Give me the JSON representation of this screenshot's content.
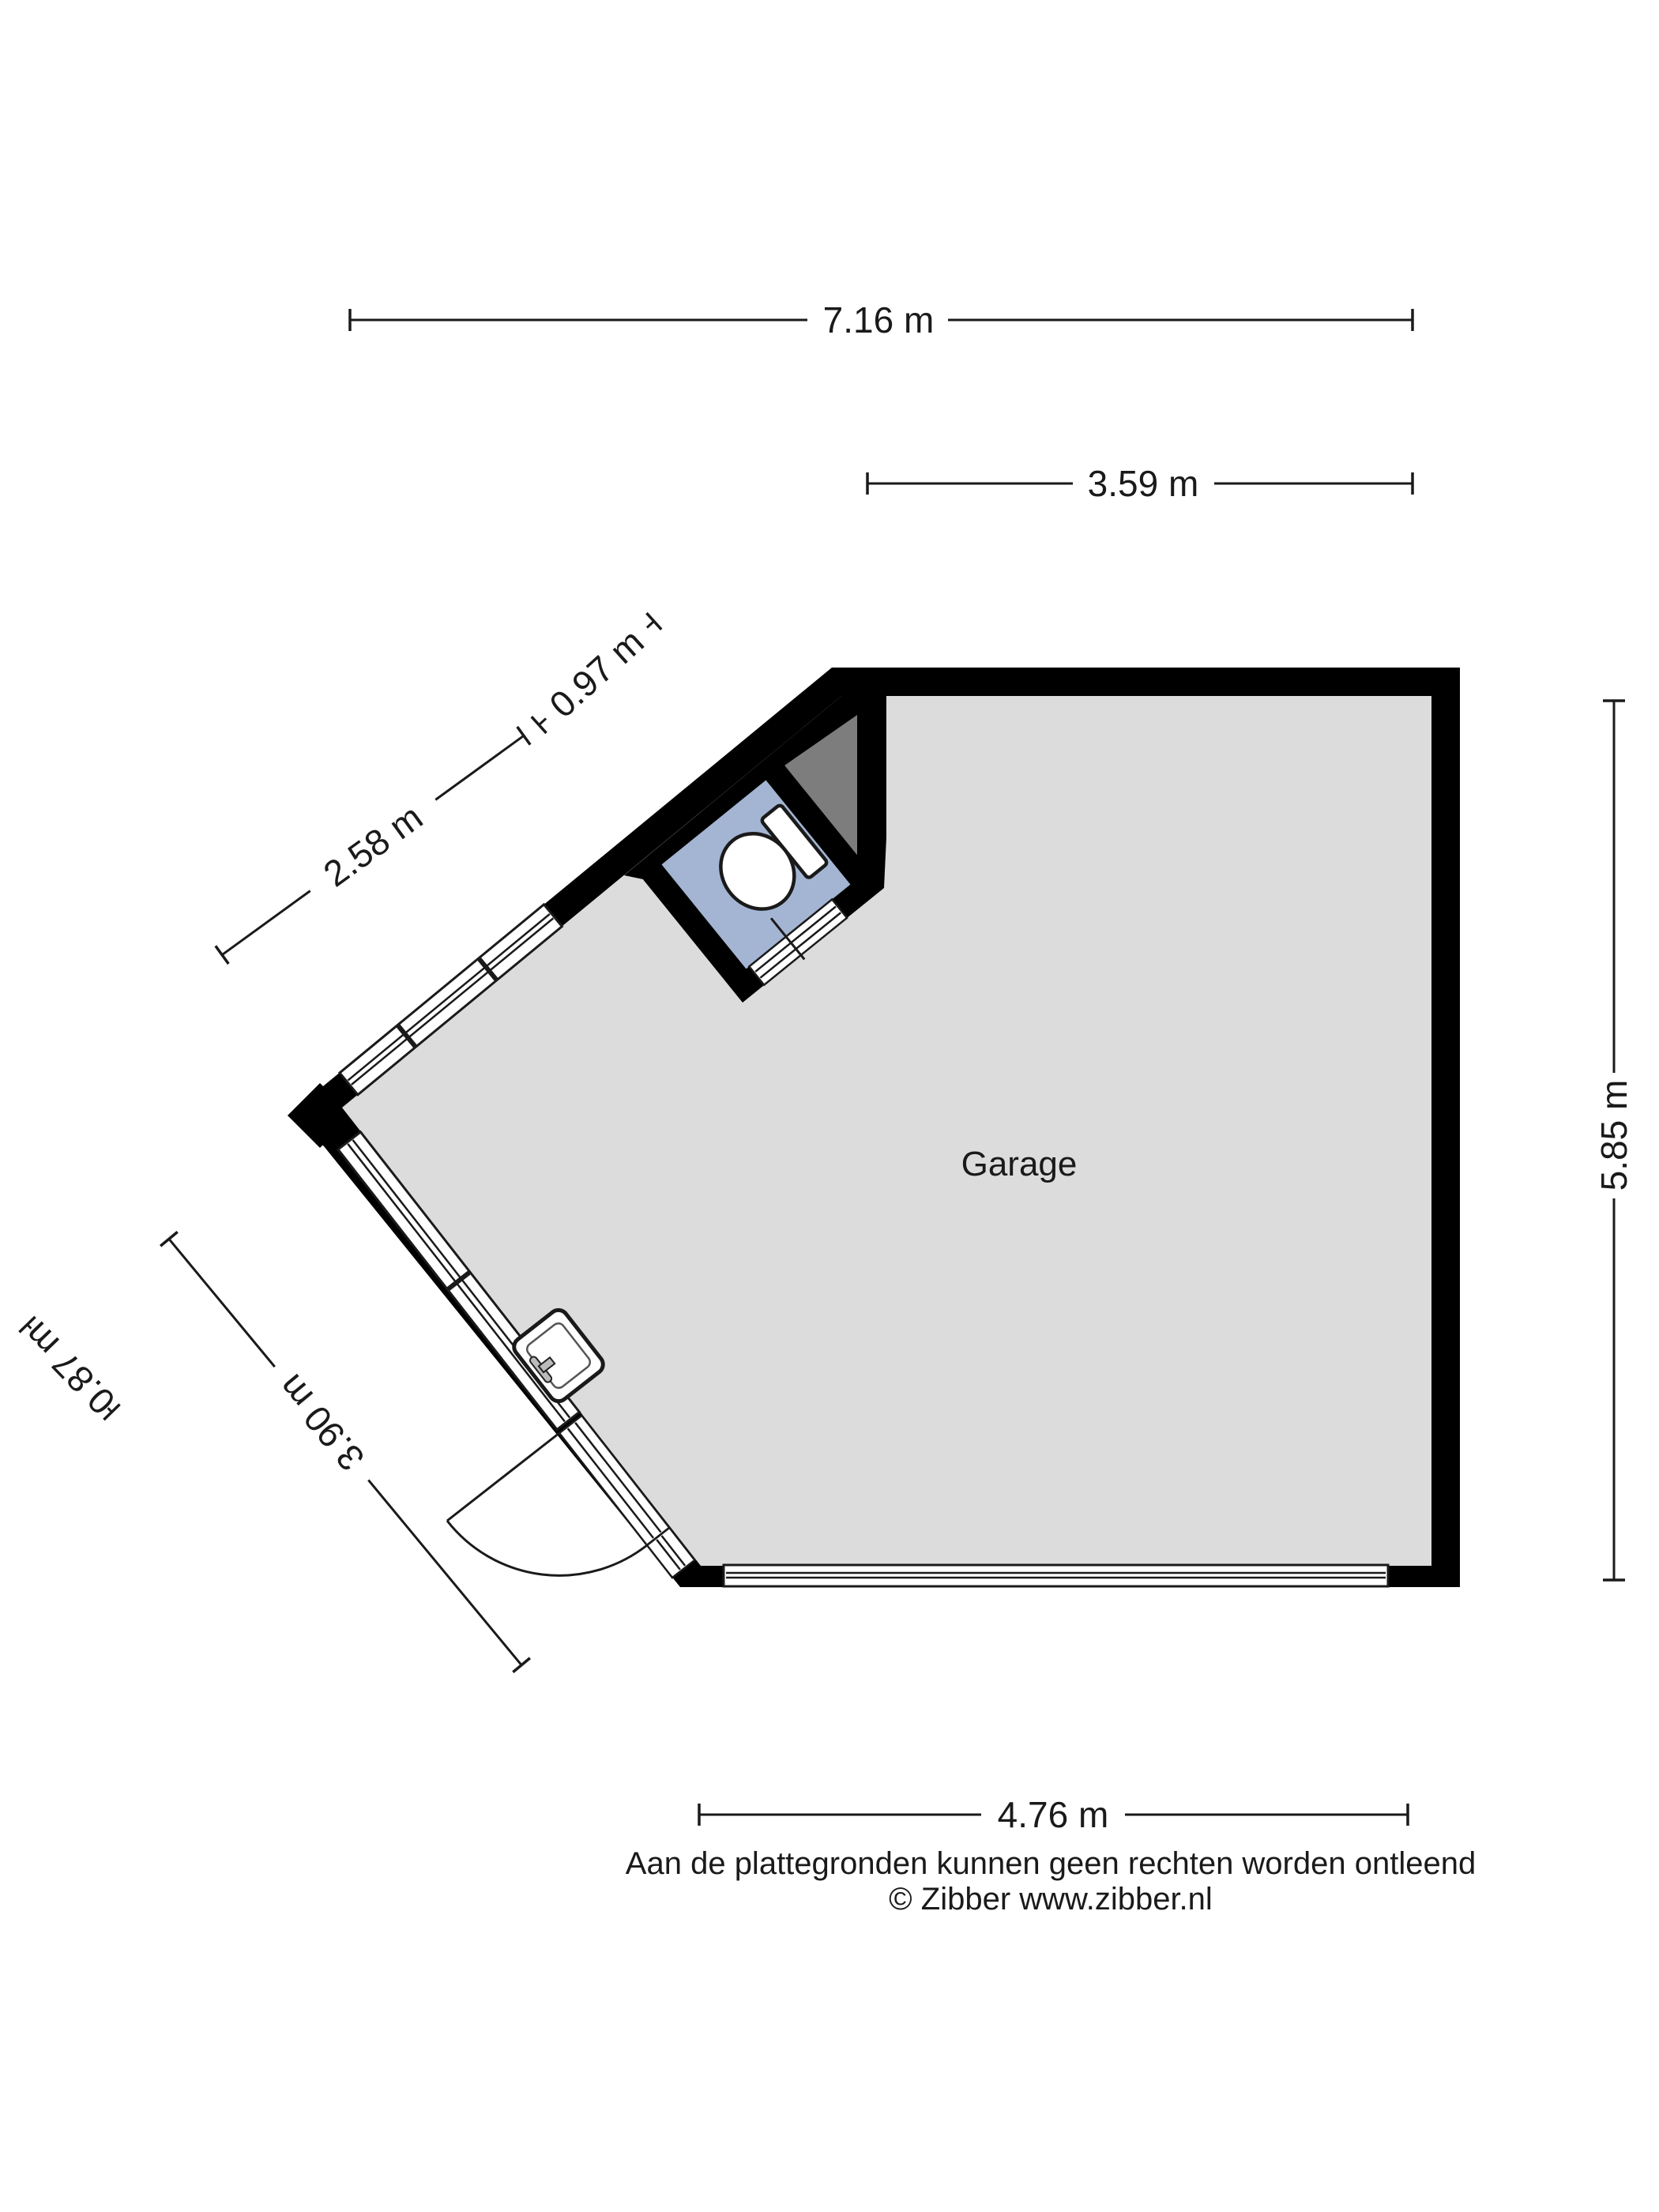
{
  "plan": {
    "room_label": "Garage"
  },
  "dimensions": {
    "top_width": "7.16 m",
    "top_partial_width": "3.59 m",
    "upper_diagonal_small": "0.97 m",
    "upper_diagonal": "2.58 m",
    "right_height": "5.85 m",
    "lower_diagonal": "3.90 m",
    "lower_diagonal_small": "0.87 m",
    "bottom_width": "4.76 m"
  },
  "footer": {
    "disclaimer": "Aan de plattegronden kunnen geen rechten worden ontleend",
    "credit": "© Zibber www.zibber.nl"
  },
  "colors": {
    "wall": "#000000",
    "floor": "#dcdcdc",
    "wc_floor": "#a3b5d2",
    "shade": "#7d7d7d",
    "fixture_fill": "#ffffff",
    "line": "#1a1a1a",
    "background": "#ffffff"
  }
}
